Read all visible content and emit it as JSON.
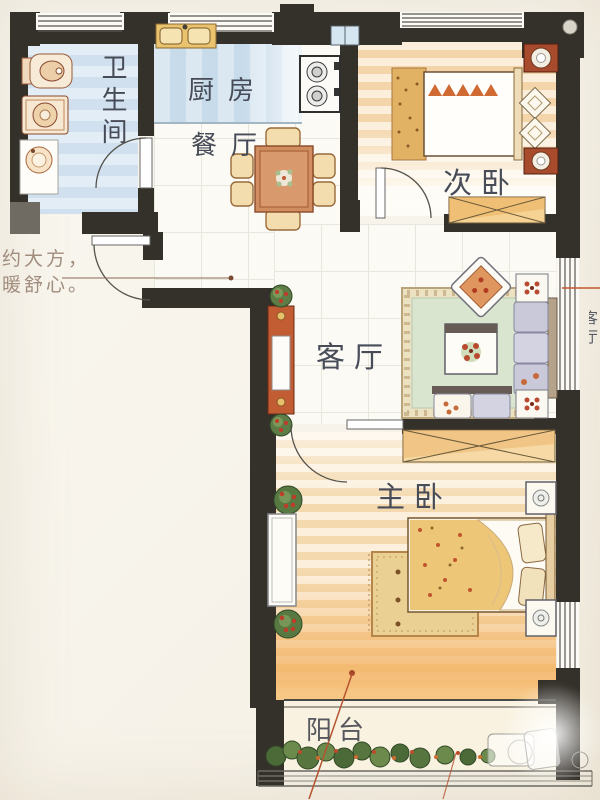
{
  "plan": {
    "title": "apartment-floor-plan",
    "rooms": {
      "bathroom": {
        "label": "卫生间"
      },
      "kitchen": {
        "label": "厨房"
      },
      "dining": {
        "label": "餐厅"
      },
      "bedroom2": {
        "label": "次卧"
      },
      "living": {
        "label": "客厅"
      },
      "master": {
        "label": "主卧"
      },
      "balcony": {
        "label": "阳台"
      }
    }
  },
  "annotations": {
    "tagline_line1": "约大方，",
    "tagline_line2": "暖舒心。",
    "right_label_partial": "客厅"
  },
  "colors": {
    "wall": "#34302a",
    "annotation_red": "#b5542f",
    "bath_blue": "#d0e0ee",
    "warm_floor_stripe": "#f3d5a9",
    "rug_green": "#d9e5cf",
    "label_text": "#474c58"
  }
}
